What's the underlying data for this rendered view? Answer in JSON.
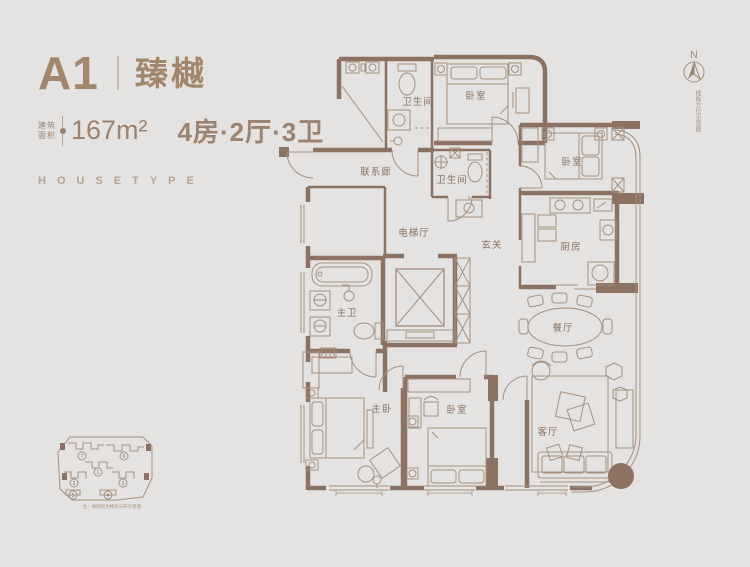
{
  "colors": {
    "background": "#e4e3e1",
    "wall": "#8b7262",
    "line": "#a69080",
    "accent_text": "#a2876f"
  },
  "header": {
    "unit_code": "A1",
    "unit_name": "臻樾",
    "area_label_line1": "建筑",
    "area_label_line2": "面积",
    "area_value": "167m²",
    "layout_spec": "4房·2厅·3卫",
    "housetype": "HOUSETYPE"
  },
  "compass": {
    "n": "N",
    "note": "楼栋方位示意图"
  },
  "rooms": [
    {
      "id": "bath-top",
      "label": "卫生间"
    },
    {
      "id": "bedroom-top",
      "label": "卧室"
    },
    {
      "id": "corridor",
      "label": "联系廊"
    },
    {
      "id": "bath-middle",
      "label": "卫生间"
    },
    {
      "id": "bedroom-right",
      "label": "卧室"
    },
    {
      "id": "elevator-hall",
      "label": "电梯厅"
    },
    {
      "id": "foyer",
      "label": "玄关"
    },
    {
      "id": "kitchen",
      "label": "厨房"
    },
    {
      "id": "master-bath",
      "label": "主卫"
    },
    {
      "id": "dining",
      "label": "餐厅"
    },
    {
      "id": "master-bedroom",
      "label": "主卧"
    },
    {
      "id": "bedroom-bottom",
      "label": "卧室"
    },
    {
      "id": "living",
      "label": "客厅"
    }
  ],
  "siteplan": {
    "numbers": [
      "7",
      "6",
      "1",
      "2",
      "3",
      "5",
      "4"
    ],
    "caption": "注：本图仅为楼栋分布示意图"
  }
}
